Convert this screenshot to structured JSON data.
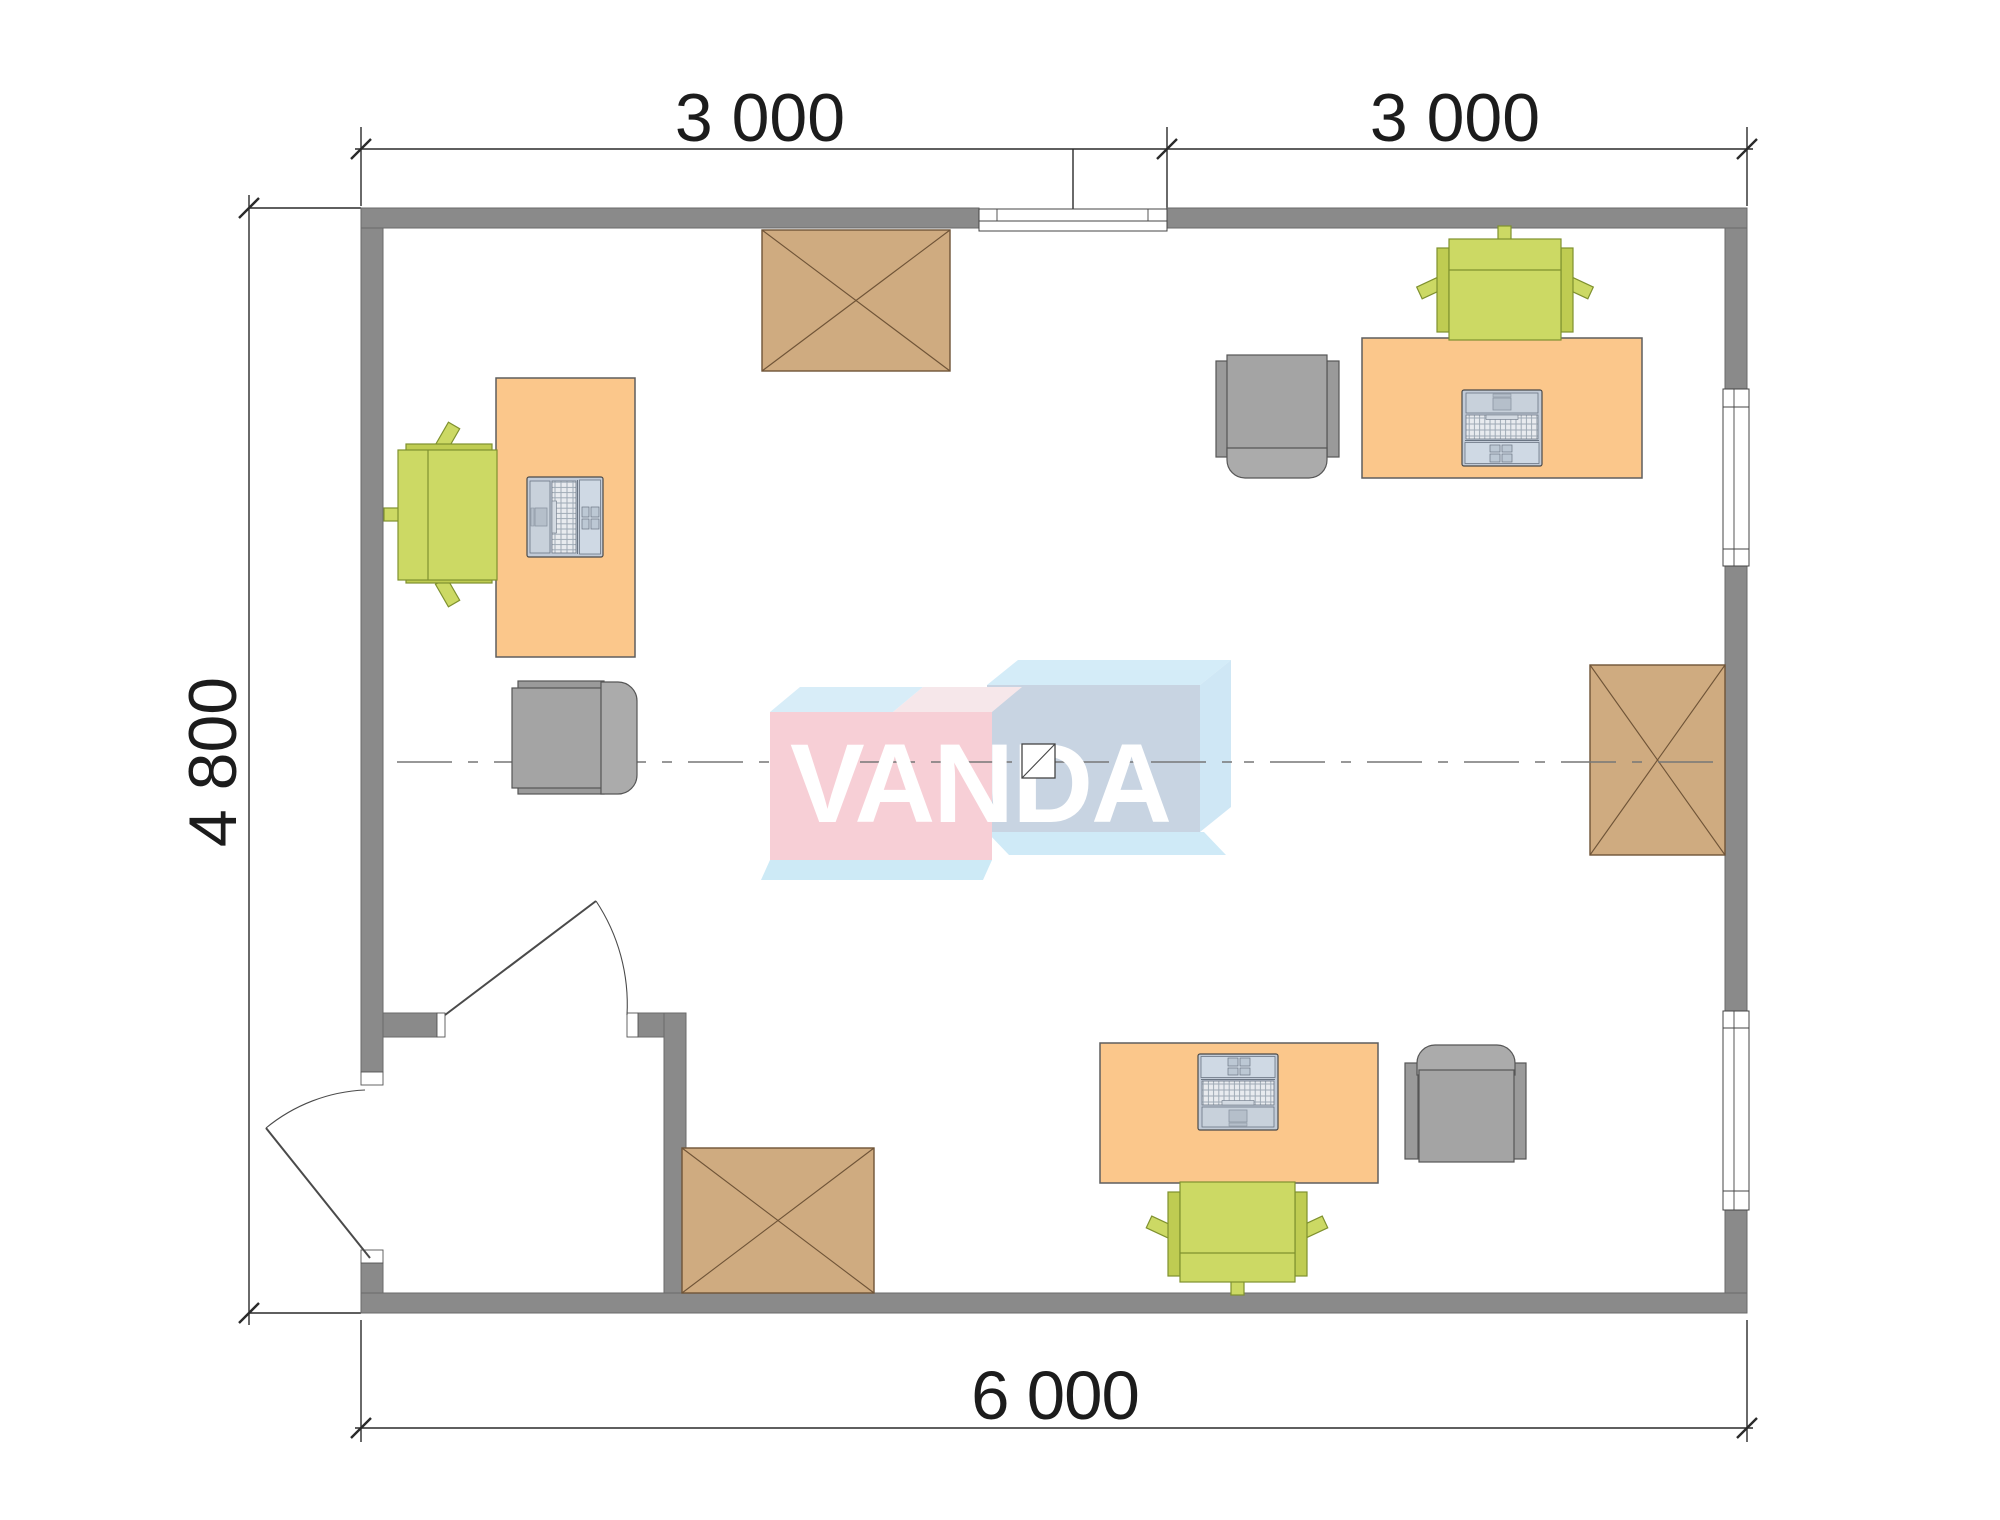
{
  "plan": {
    "type": "office floor plan",
    "dimensions": {
      "top_left_label": "3 000",
      "top_right_label": "3 000",
      "left_label": "4 800",
      "bottom_label": "6 000"
    },
    "logo": {
      "text": "VANDA",
      "pink_front": "#f7cfd6",
      "blue_front": "#c8d4e2",
      "light_blue_face": "#d4ecf8",
      "text_color": "#ffffff"
    },
    "colors": {
      "wall": "#8a8a8a",
      "wall_outline": "#6a6a6a",
      "desk": "#fbc78b",
      "crossed_table": "#cfab80",
      "crossed_table_line": "#6f5437",
      "office_chair_green": "#cbd861",
      "armchair_gray": "#a4a4a4",
      "laptop_body": "#c2cbd7",
      "dimension_ink": "#1c1c1c",
      "centerline": "#777777"
    },
    "furniture": {
      "desks": [
        "desk-top-left",
        "desk-top-right",
        "desk-bottom"
      ],
      "laptops": [
        "laptop-top-left",
        "laptop-top-right",
        "laptop-bottom"
      ],
      "office_chairs_green": [
        "chair-green-top-left",
        "chair-green-top-right",
        "chair-green-bottom"
      ],
      "armchairs_gray": [
        "armchair-mid-left",
        "armchair-top-right",
        "armchair-bottom"
      ],
      "crossed_tables": [
        "table-top-middle",
        "table-right-middle",
        "table-bottom-left"
      ]
    },
    "openings": {
      "windows": [
        "window-top",
        "window-right-upper",
        "window-right-lower"
      ],
      "doors": [
        "door-entrance",
        "door-interior"
      ]
    }
  }
}
